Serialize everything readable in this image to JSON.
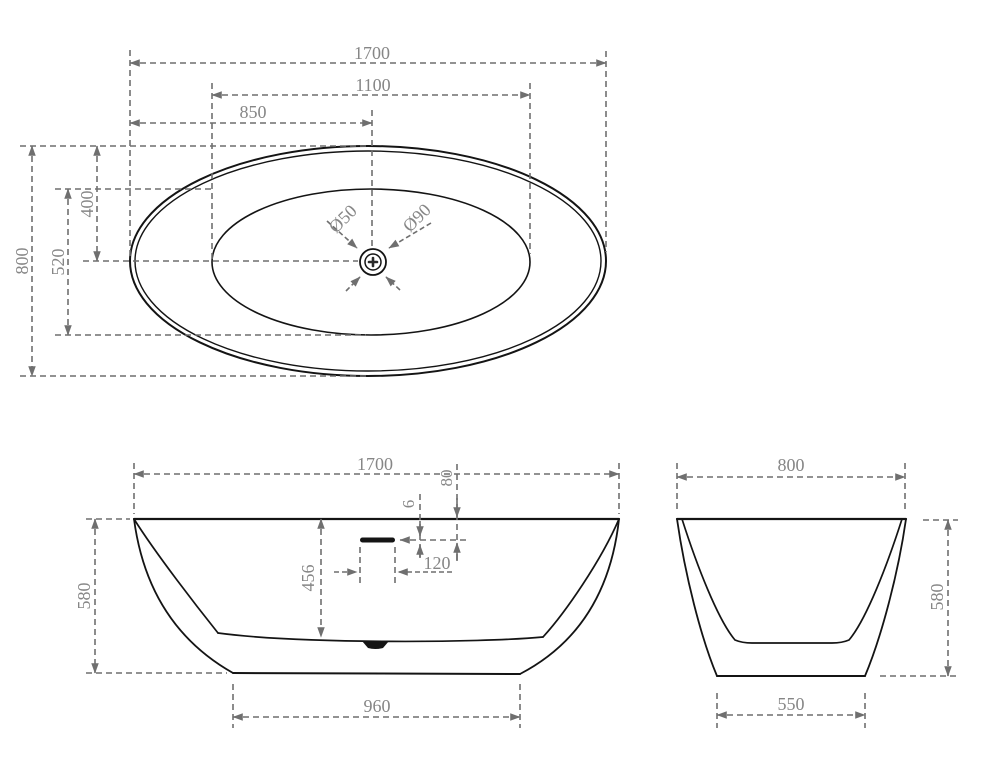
{
  "drawing": {
    "kind": "technical-drawing",
    "subject": "freestanding oval bathtub",
    "units": "mm",
    "colors": {
      "outline": "#141414",
      "dimension_line": "#6f6f6f",
      "dimension_text": "#868686",
      "background": "#ffffff"
    },
    "views": {
      "top": {
        "overall_length": "1700",
        "inner_length": "1100",
        "drain_from_left": "850",
        "overall_width": "800",
        "drain_from_top": "400",
        "inner_width": "520",
        "drain_diameter": "Ø50",
        "flange_diameter": "Ø90"
      },
      "front": {
        "overall_length": "1700",
        "overflow_from_rim": "80",
        "overflow_slot_height": "6",
        "overflow_slot_width": "120",
        "inner_depth": "456",
        "overall_height": "580",
        "base_length": "960"
      },
      "side": {
        "overall_width": "800",
        "overall_height": "580",
        "base_width": "550"
      }
    }
  }
}
